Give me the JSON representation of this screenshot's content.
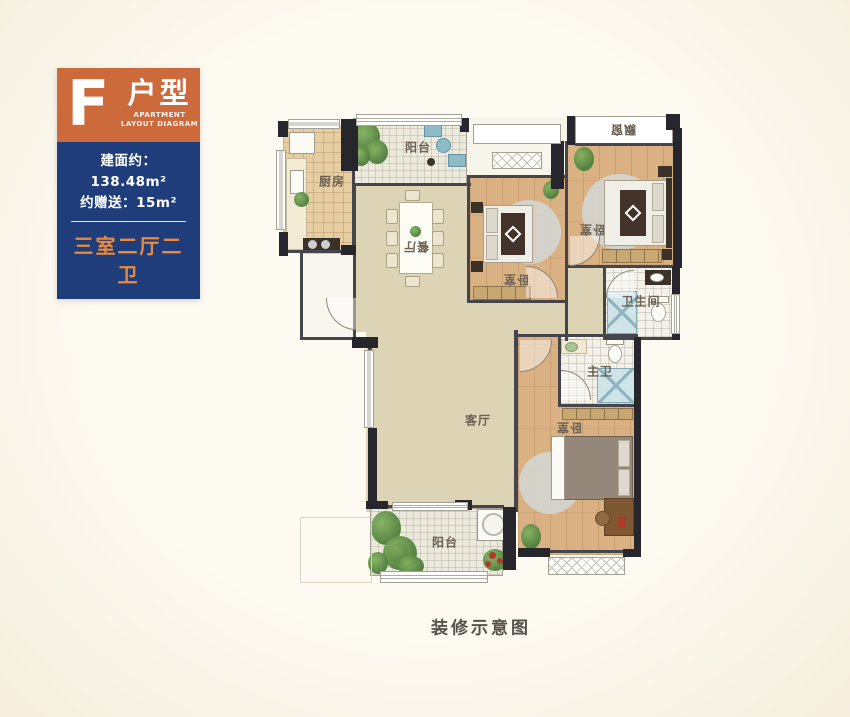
{
  "badge": {
    "letter": "F",
    "type": "户型",
    "subtitle_line1": "APARTMENT",
    "subtitle_line2": "LAYOUT DIAGRAM",
    "area": "建面约：138.48m²",
    "bonus": "约赠送：15m²",
    "config": "三室二厅二卫"
  },
  "plan": {
    "rooms": {
      "balcony_top": "阳台",
      "kitchen": "厨房",
      "dining": "餐厅",
      "bedroom_mid": "卧室",
      "bedroom_right": "卧室",
      "bay_window": "飘窗",
      "bathroom": "卫生间",
      "master_bath": "主卫",
      "living": "客厅",
      "bedroom_master": "卧室",
      "balcony_bottom": "阳台"
    },
    "caption": "装修示意图"
  },
  "colors": {
    "accent_orange": "#cd6a3c",
    "panel_blue": "#203d7b",
    "config_orange": "#e98a3e",
    "wall_dark": "#26262c",
    "background": "#fcf8ee"
  }
}
